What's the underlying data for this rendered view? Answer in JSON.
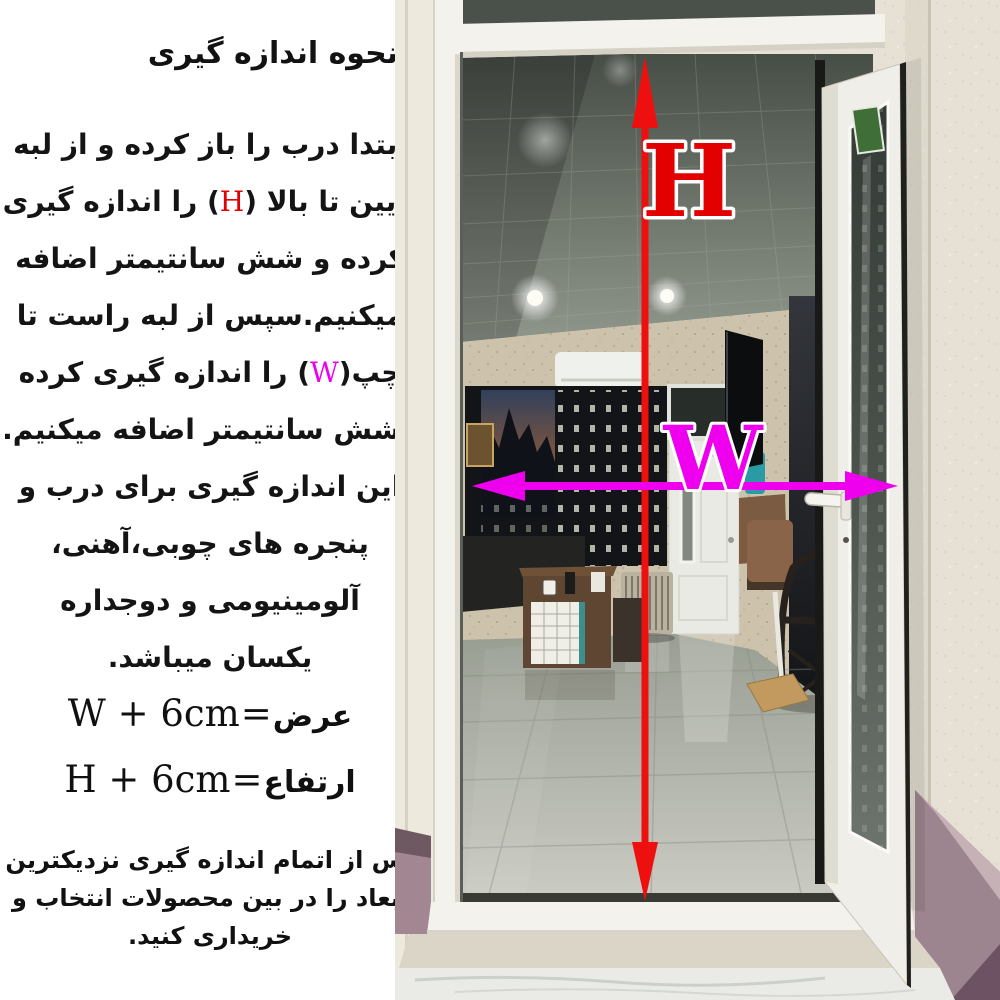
{
  "title": "نحوه اندازه گیری",
  "paragraph": {
    "lines": [
      {
        "segs": [
          "ابتدا درب را باز کرده و از لبه"
        ]
      },
      {
        "segs": [
          "پایین تا بالا (",
          "H",
          ") را اندازه گیری"
        ]
      },
      {
        "segs": [
          "کرده و شش سانتیمتر اضافه"
        ]
      },
      {
        "segs": [
          "میکنیم.سپس از لبه راست تا"
        ]
      },
      {
        "segs": [
          "چپ(",
          "W",
          ") را اندازه گیری کرده"
        ]
      },
      {
        "segs": [
          "وشش سانتیمتر اضافه میکنیم."
        ]
      },
      {
        "segs": [
          "این اندازه گیری برای درب و"
        ]
      },
      {
        "segs": [
          "پنجره های چوبی،آهنی،"
        ]
      },
      {
        "segs": [
          "آلومینیومی و دوجداره"
        ]
      },
      {
        "segs": [
          "یکسان میباشد."
        ]
      }
    ]
  },
  "formulas": [
    {
      "label": "عرض",
      "eq": "=",
      "expr": "W + 6cm"
    },
    {
      "label": "ارتفاع",
      "eq": "=",
      "expr": "H + 6cm"
    }
  ],
  "footer_note": {
    "lines": [
      "پس از اتمام اندازه گیری نزدیکترین",
      "ابعاد را در بین محصولات انتخاب و",
      "خریداری کنید."
    ]
  },
  "photo": {
    "h_label": "H",
    "w_label": "W",
    "colors": {
      "height_arrow": "#ee0f0f",
      "width_arrow": "#ee00ee",
      "h_letter": "#e30000",
      "w_letter": "#ee00ee"
    }
  }
}
